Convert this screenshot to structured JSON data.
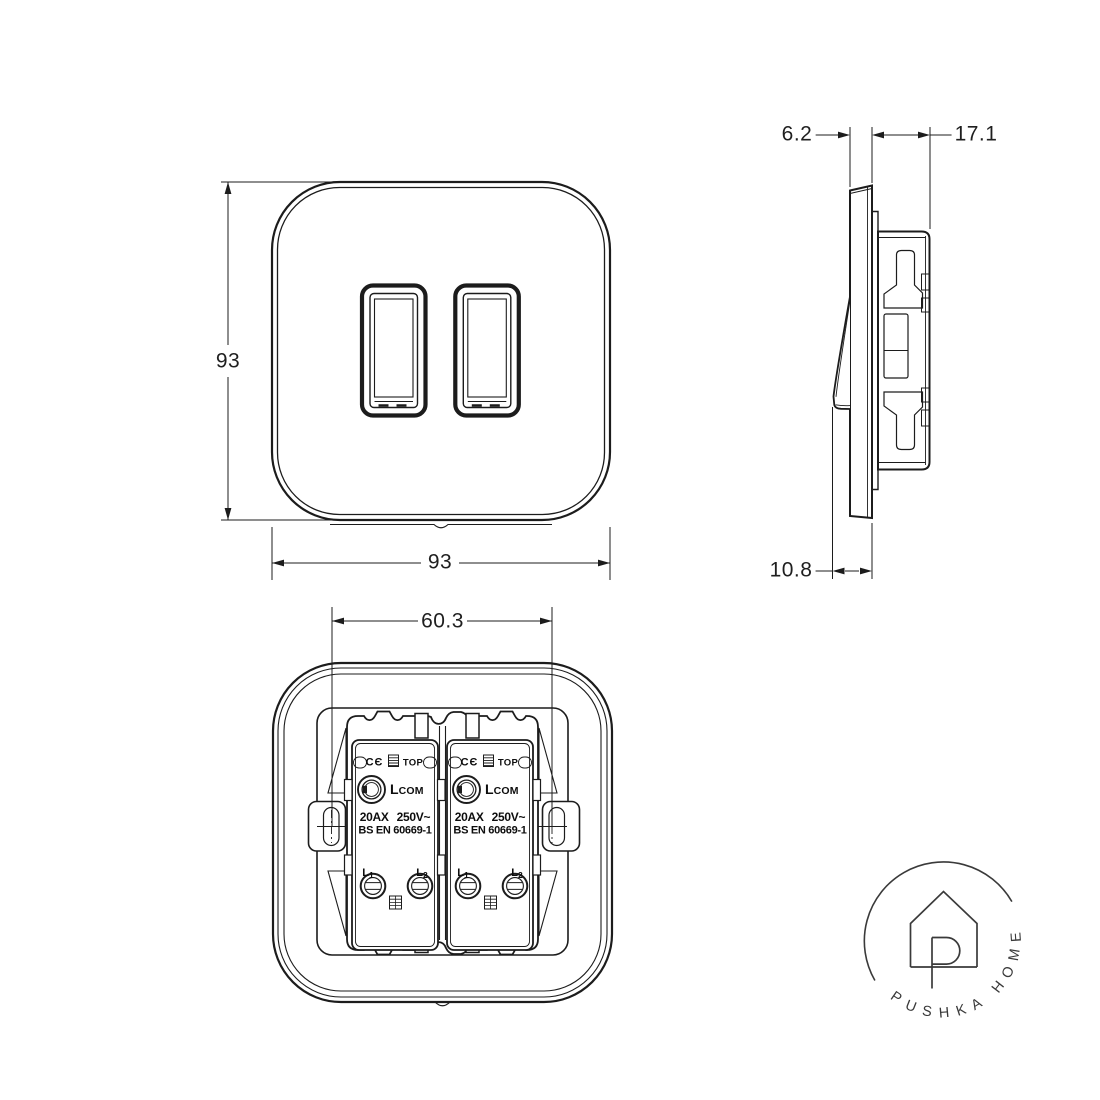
{
  "page": {
    "background": "#ffffff",
    "line_color": "#1c1c1c",
    "logo_color": "#3a3a3a"
  },
  "front_view": {
    "height_label": "93",
    "width_label": "93"
  },
  "side_view": {
    "plate_thickness_label": "6.2",
    "depth_label": "17.1",
    "protrusion_label": "10.8"
  },
  "back_view": {
    "mounting_centres_label": "60.3",
    "module": {
      "ce_mark": "CЄ",
      "top_label": "TOP",
      "terminal_l": "L",
      "terminal_com": "COM",
      "rating_line1": "20AX 250V~",
      "rating_line2": "BS EN 60669-1",
      "l1": {
        "letter": "L",
        "sub": "1"
      },
      "l2": {
        "letter": "L",
        "sub": "2"
      }
    }
  },
  "logo": {
    "brand": "PUSHKA HOME"
  }
}
